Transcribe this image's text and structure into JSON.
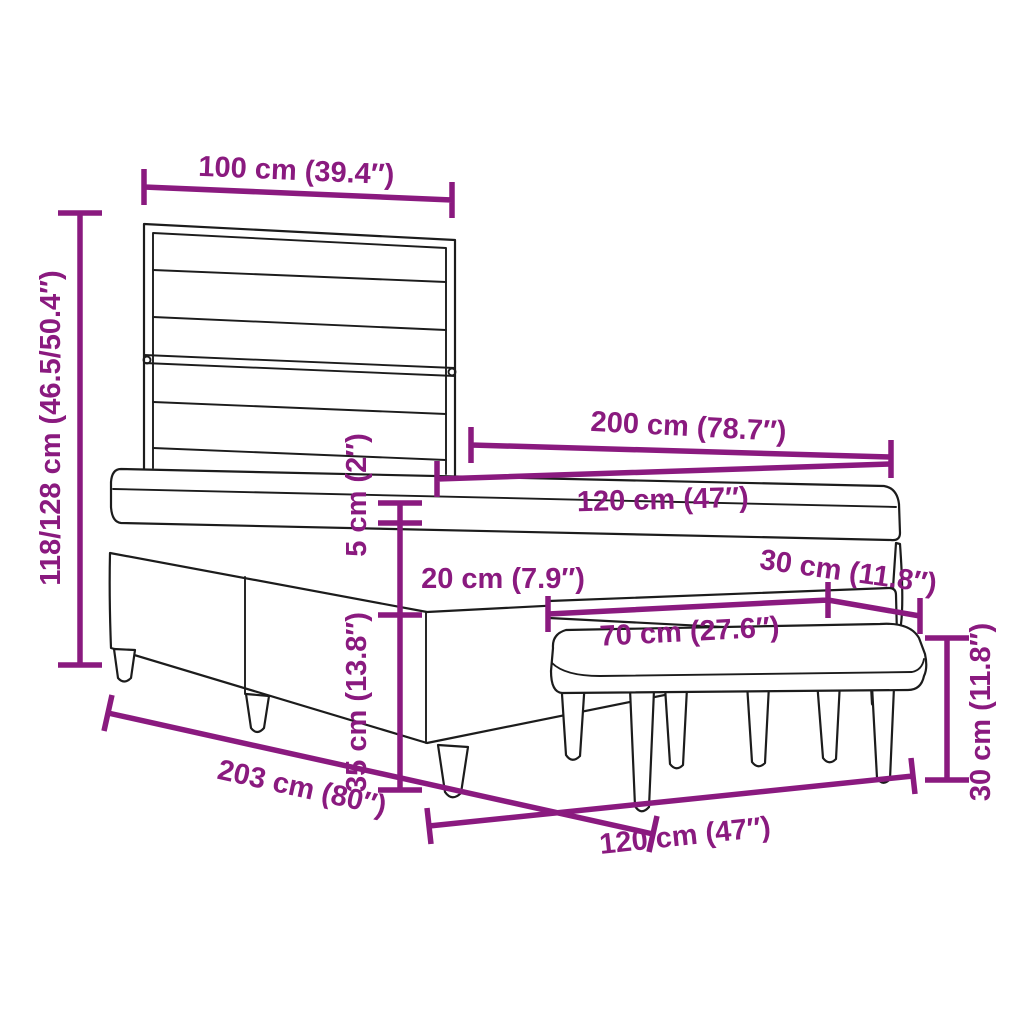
{
  "figure": {
    "type": "product-dimension-diagram",
    "subject": "box spring bed with slatted headboard, mattress with topper and upholstered bench",
    "background_color": "#ffffff",
    "line_art_color": "#1c1c1c",
    "dimension_color": "#8A1A7F"
  },
  "dimensions": {
    "headboard_width": {
      "label": "100 cm (39.4″)"
    },
    "overall_height": {
      "label": "118/128 cm (46.5/50.4″)"
    },
    "bed_length": {
      "label": "200 cm (78.7″)"
    },
    "bed_width": {
      "label": "120 cm (47″)"
    },
    "topper_thickness": {
      "label": "5 cm (2″)"
    },
    "mattress_thickness": {
      "label": "20 cm (7.9″)"
    },
    "bench_depth": {
      "label": "30 cm (11.8″)"
    },
    "bench_length": {
      "label": "70 cm (27.6″)"
    },
    "base_height": {
      "label": "35 cm (13.8″)"
    },
    "bench_seat_height": {
      "label": "30 cm (11.8″)"
    },
    "frame_length": {
      "label": "203 cm (80″)"
    },
    "frame_width": {
      "label": "120 cm (47″)"
    }
  }
}
